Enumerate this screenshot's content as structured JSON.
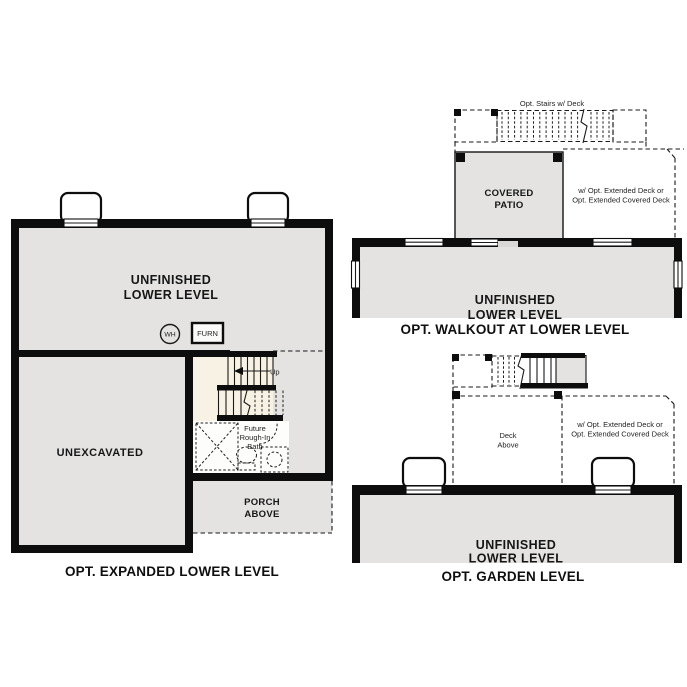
{
  "colors": {
    "wall": "#0d0d0d",
    "room_fill": "#e4e3e1",
    "stair_fill": "#f8f2e4",
    "bath_fill": "#fdfdfb",
    "door_opening": "#d9d8d6",
    "background": "#ffffff"
  },
  "plans": {
    "expanded": {
      "caption": "OPT. EXPANDED LOWER LEVEL",
      "room": [
        "UNFINISHED",
        "LOWER LEVEL"
      ],
      "unexcavated": "UNEXCAVATED",
      "porch": [
        "PORCH",
        "ABOVE"
      ],
      "wh": "WH",
      "furn": "FURN",
      "up": "Up",
      "bath": [
        "Future",
        "Rough-In",
        "Bath"
      ]
    },
    "walkout": {
      "caption": "OPT. WALKOUT AT LOWER LEVEL",
      "stairs_note": "Opt. Stairs w/ Deck",
      "patio": [
        "COVERED",
        "PATIO"
      ],
      "deck_note": [
        "w/ Opt. Extended Deck or",
        "Opt. Extended Covered Deck"
      ],
      "room": [
        "UNFINISHED",
        "LOWER LEVEL"
      ]
    },
    "garden": {
      "caption": "OPT. GARDEN LEVEL",
      "deck_above": [
        "Deck",
        "Above"
      ],
      "deck_note": [
        "w/ Opt. Extended Deck or",
        "Opt. Extended Covered Deck"
      ],
      "room": [
        "UNFINISHED",
        "LOWER LEVEL"
      ]
    }
  }
}
